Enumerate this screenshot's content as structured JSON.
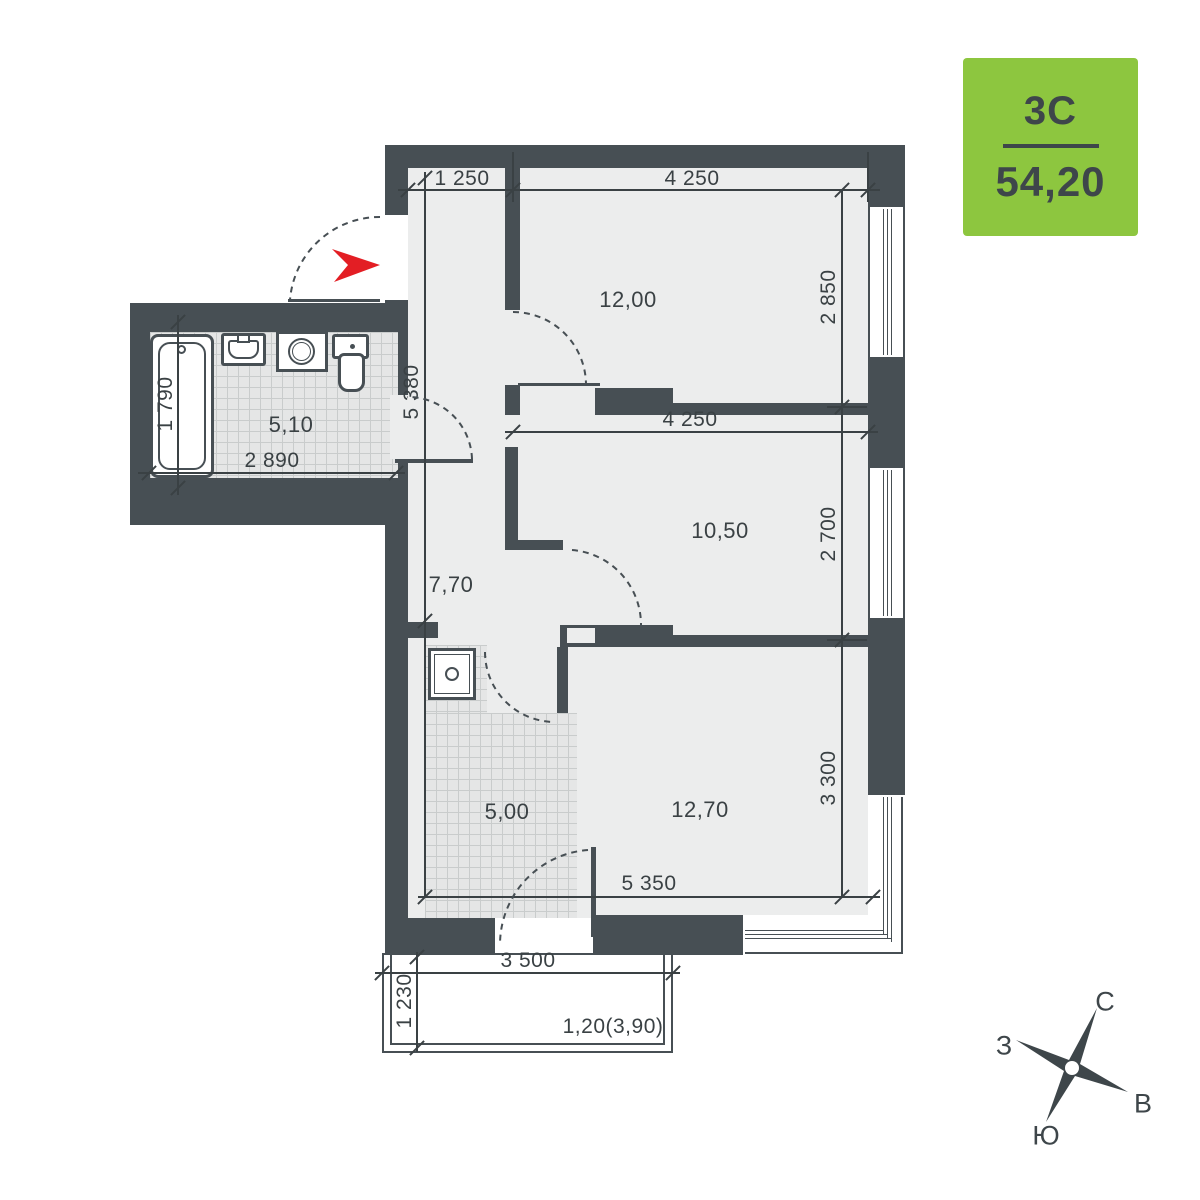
{
  "badge": {
    "plan_type": "3С",
    "area": "54,20"
  },
  "rooms": {
    "living": "12,00",
    "bedroom": "10,50",
    "kitchen_living": "12,70",
    "kitchen": "5,00",
    "bathroom": "5,10",
    "hallway": "7,70"
  },
  "dims": {
    "top_left": "1 250",
    "top_right": "4 250",
    "right_upper": "2 850",
    "mid_width": "4 250",
    "right_middle": "2 700",
    "right_lower": "3 300",
    "bottom_inner": "5 350",
    "hall_height": "5 380",
    "bath_height": "1 790",
    "bath_width": "2 890",
    "balcony_width": "3 500",
    "balcony_depth": "1 230",
    "balcony_area": "1,20(3,90)"
  },
  "compass": {
    "north": "С",
    "east": "В",
    "south": "Ю",
    "west": "З"
  },
  "colors": {
    "wall": "#474F54",
    "floor": "#ECEDED",
    "accent_green": "#8DC63F",
    "arrow_red": "#E31E24",
    "text": "#3A4144"
  }
}
